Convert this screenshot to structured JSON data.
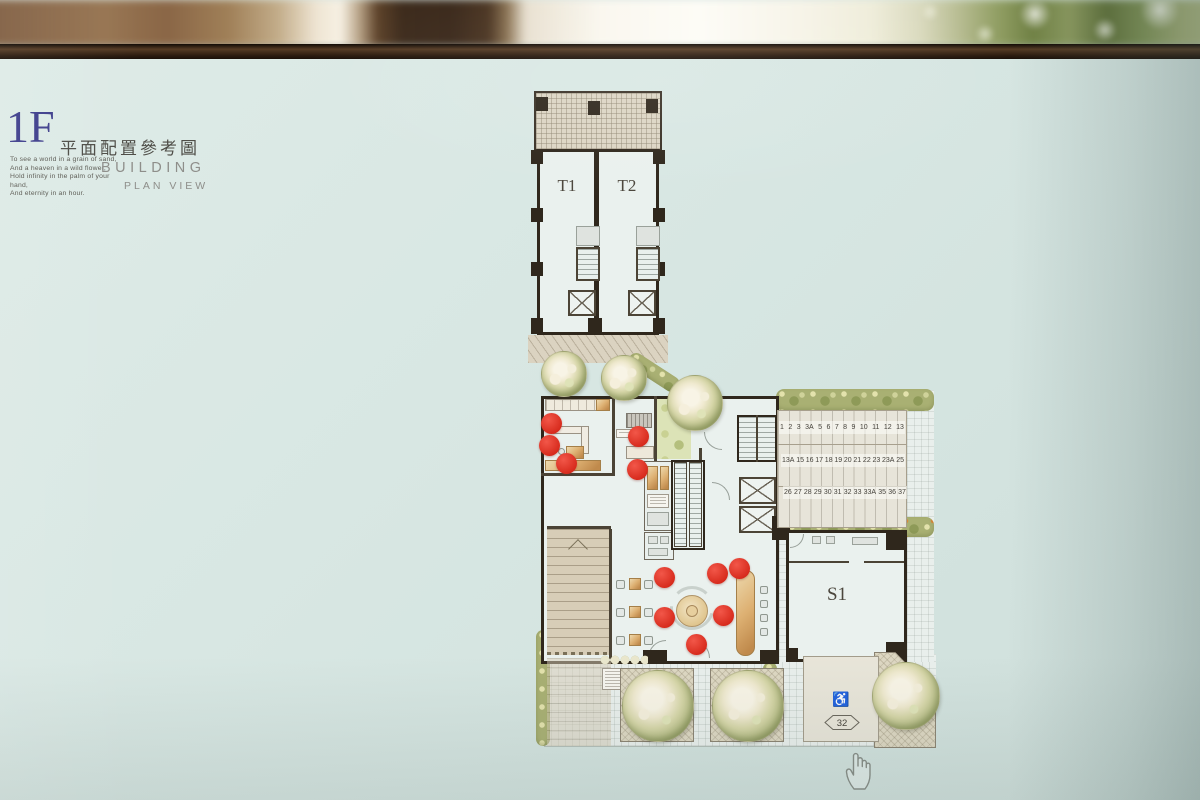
{
  "title": {
    "floor": "1F",
    "subtitle_zh": "平面配置參考圖",
    "building": "BUILDING",
    "plan_view": "PLAN VIEW",
    "poem": [
      "To see a world in a grain of sand,",
      "And a heaven in a wild flower,",
      "Hold infinity in the palm of your hand,",
      "And eternity in an hour."
    ],
    "accent_color": "#3e3e8c"
  },
  "plan": {
    "towers": [
      {
        "label": "T1"
      },
      {
        "label": "T2"
      }
    ],
    "s1": {
      "label": "S1"
    },
    "parking_rows": [
      [
        "1",
        "2",
        "3",
        "3A",
        "5",
        "6",
        "7",
        "8",
        "9",
        "10",
        "11",
        "12",
        "13"
      ],
      [
        "13A",
        "15",
        "16",
        "17",
        "18",
        "19",
        "20",
        "21",
        "22",
        "23",
        "23A",
        "25"
      ],
      [
        "26",
        "27",
        "28",
        "29",
        "30",
        "31",
        "32",
        "33",
        "33A",
        "35",
        "36",
        "37"
      ]
    ],
    "accessible": {
      "icon": "wheelchair-icon",
      "number": "32"
    },
    "red_dot_color": "#d6291b",
    "red_dots": [
      [
        551,
        423
      ],
      [
        549,
        445
      ],
      [
        566,
        463
      ],
      [
        638,
        436
      ],
      [
        637,
        469
      ],
      [
        664,
        577
      ],
      [
        717,
        573
      ],
      [
        739,
        568
      ],
      [
        664,
        617
      ],
      [
        723,
        615
      ],
      [
        696,
        644
      ]
    ],
    "trees": [
      {
        "x": 563,
        "y": 373,
        "r": 22
      },
      {
        "x": 623,
        "y": 377,
        "r": 22
      },
      {
        "x": 694,
        "y": 402,
        "r": 27
      },
      {
        "x": 657,
        "y": 705,
        "r": 35
      },
      {
        "x": 747,
        "y": 705,
        "r": 35
      },
      {
        "x": 905,
        "y": 695,
        "r": 33
      }
    ],
    "colors": {
      "wall": "#2f271c",
      "floor": "#eaf1ee",
      "paving": "#d9d0bd",
      "hedge": "#a9b073"
    }
  },
  "cursor": {
    "icon": "hand-pointer-icon"
  }
}
